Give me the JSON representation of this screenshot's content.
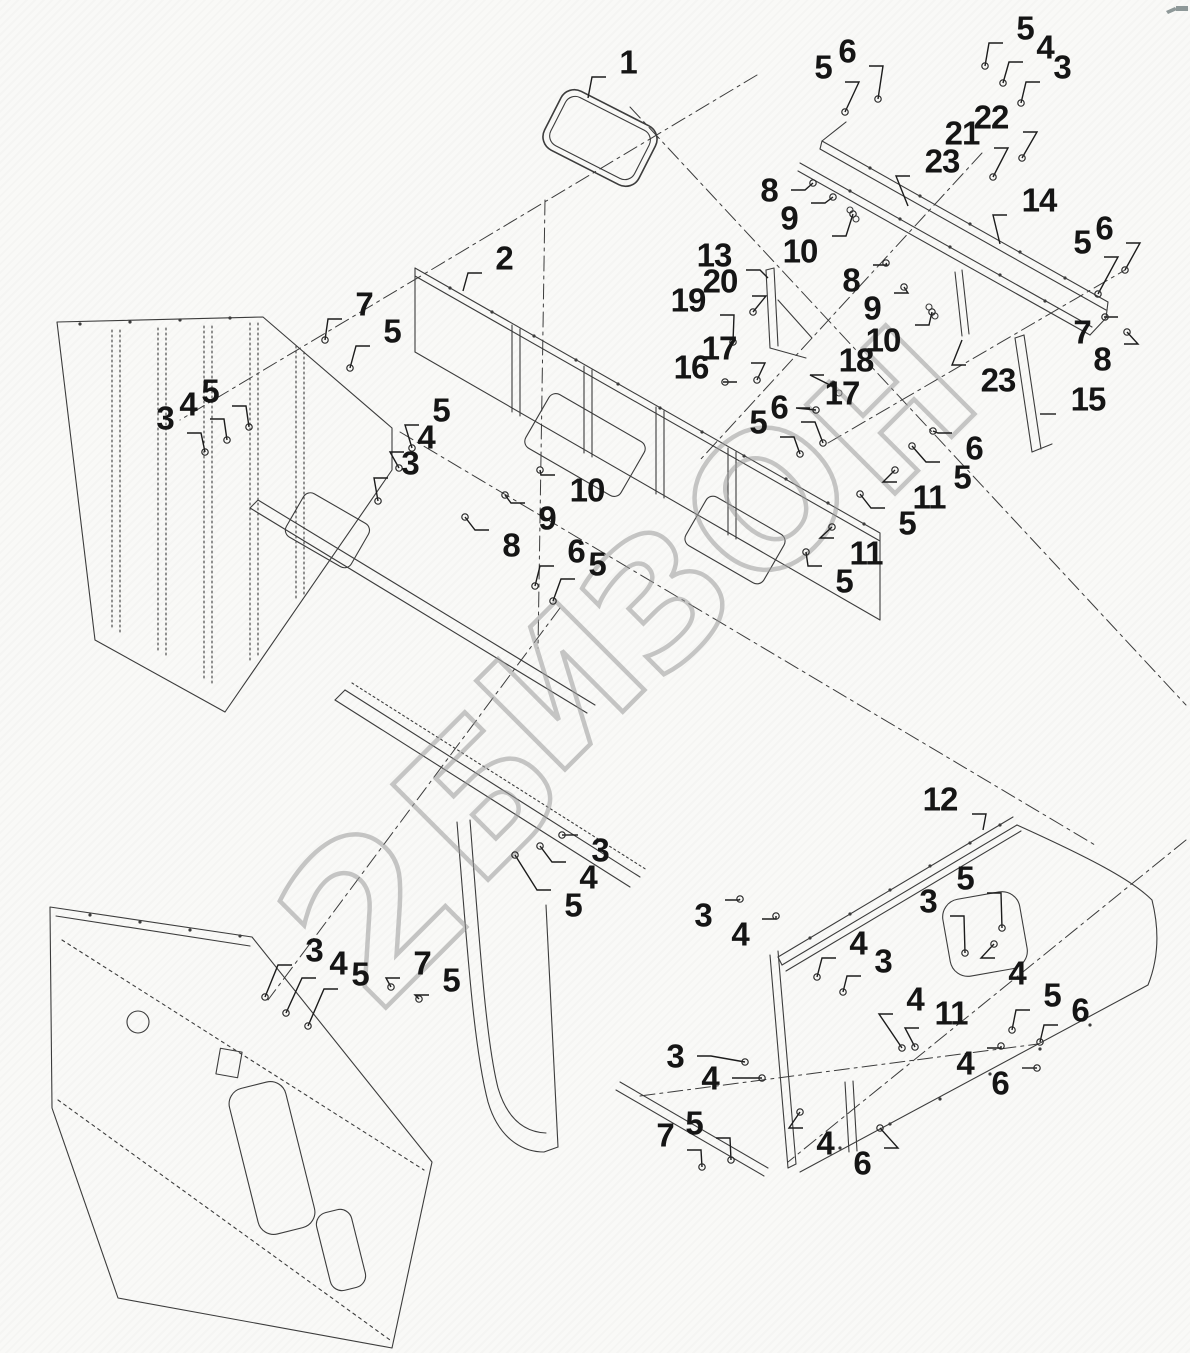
{
  "page": {
    "width": 1190,
    "height": 1353,
    "background": "#f9f9f7",
    "line_color": "#3c3c3c",
    "leader_color": "#1c1c1c",
    "label_color": "#151515"
  },
  "watermark": {
    "color": "#9b9b9b",
    "rotation_deg": -45,
    "letters": [
      {
        "ch": "2",
        "x": 374,
        "y": 914,
        "size": 215
      },
      {
        "ch": "Б",
        "x": 481,
        "y": 797,
        "size": 185
      },
      {
        "ch": "И",
        "x": 563,
        "y": 688,
        "size": 172
      },
      {
        "ch": "З",
        "x": 660,
        "y": 600,
        "size": 172
      },
      {
        "ch": "О",
        "x": 768,
        "y": 501,
        "size": 182
      },
      {
        "ch": "Н",
        "x": 893,
        "y": 412,
        "size": 172
      }
    ]
  },
  "no_marker_parts": [
    "1",
    "2",
    "12",
    "13",
    "14",
    "15",
    "18",
    "23"
  ],
  "callouts": [
    {
      "t": "1",
      "x": 628,
      "y": 62,
      "tx": 588,
      "ty": 98
    },
    {
      "t": "5",
      "x": 823,
      "y": 67,
      "tx": 845,
      "ty": 112
    },
    {
      "t": "6",
      "x": 847,
      "y": 51,
      "tx": 878,
      "ty": 99
    },
    {
      "t": "5",
      "x": 1025,
      "y": 28,
      "tx": 985,
      "ty": 66
    },
    {
      "t": "4",
      "x": 1045,
      "y": 47,
      "tx": 1003,
      "ty": 83
    },
    {
      "t": "3",
      "x": 1062,
      "y": 67,
      "tx": 1021,
      "ty": 103
    },
    {
      "t": "22",
      "x": 991,
      "y": 117,
      "tx": 1022,
      "ty": 158
    },
    {
      "t": "21",
      "x": 962,
      "y": 133,
      "tx": 993,
      "ty": 177
    },
    {
      "t": "23",
      "x": 942,
      "y": 161,
      "tx": 908,
      "ty": 206
    },
    {
      "t": "8",
      "x": 769,
      "y": 190,
      "tx": 813,
      "ty": 183
    },
    {
      "t": "9",
      "x": 789,
      "y": 218,
      "tx": 833,
      "ty": 197
    },
    {
      "t": "10",
      "x": 800,
      "y": 251,
      "tx": 853,
      "ty": 214
    },
    {
      "t": "14",
      "x": 1039,
      "y": 200,
      "tx": 1000,
      "ty": 244
    },
    {
      "t": "13",
      "x": 714,
      "y": 255,
      "tx": 768,
      "ty": 278
    },
    {
      "t": "20",
      "x": 720,
      "y": 281,
      "tx": 753,
      "ty": 312
    },
    {
      "t": "19",
      "x": 688,
      "y": 300,
      "tx": 733,
      "ty": 342
    },
    {
      "t": "2",
      "x": 504,
      "y": 258,
      "tx": 463,
      "ty": 291
    },
    {
      "t": "8",
      "x": 851,
      "y": 280,
      "tx": 886,
      "ty": 263
    },
    {
      "t": "9",
      "x": 872,
      "y": 308,
      "tx": 904,
      "ty": 287
    },
    {
      "t": "10",
      "x": 883,
      "y": 340,
      "tx": 932,
      "ty": 312
    },
    {
      "t": "6",
      "x": 1104,
      "y": 228,
      "tx": 1125,
      "ty": 270
    },
    {
      "t": "5",
      "x": 1082,
      "y": 242,
      "tx": 1098,
      "ty": 294
    },
    {
      "t": "7",
      "x": 1082,
      "y": 332,
      "tx": 1105,
      "ty": 317
    },
    {
      "t": "8",
      "x": 1102,
      "y": 359,
      "tx": 1127,
      "ty": 332
    },
    {
      "t": "16",
      "x": 691,
      "y": 367,
      "tx": 725,
      "ty": 382
    },
    {
      "t": "17",
      "x": 719,
      "y": 348,
      "tx": 757,
      "ty": 380
    },
    {
      "t": "18",
      "x": 856,
      "y": 360,
      "tx": 836,
      "ty": 388
    },
    {
      "t": "17",
      "x": 842,
      "y": 393,
      "tx": 816,
      "ty": 410
    },
    {
      "t": "23",
      "x": 998,
      "y": 380,
      "tx": 962,
      "ty": 340
    },
    {
      "t": "15",
      "x": 1088,
      "y": 399,
      "tx": 1040,
      "ty": 414
    },
    {
      "t": "7",
      "x": 364,
      "y": 304,
      "tx": 325,
      "ty": 340
    },
    {
      "t": "5",
      "x": 392,
      "y": 331,
      "tx": 350,
      "ty": 368
    },
    {
      "t": "3",
      "x": 165,
      "y": 418,
      "tx": 205,
      "ty": 452
    },
    {
      "t": "4",
      "x": 188,
      "y": 404,
      "tx": 227,
      "ty": 440
    },
    {
      "t": "5",
      "x": 210,
      "y": 391,
      "tx": 249,
      "ty": 427
    },
    {
      "t": "5",
      "x": 441,
      "y": 410,
      "tx": 412,
      "ty": 448
    },
    {
      "t": "4",
      "x": 426,
      "y": 437,
      "tx": 399,
      "ty": 468
    },
    {
      "t": "3",
      "x": 410,
      "y": 463,
      "tx": 378,
      "ty": 501
    },
    {
      "t": "10",
      "x": 587,
      "y": 490,
      "tx": 540,
      "ty": 470
    },
    {
      "t": "9",
      "x": 547,
      "y": 518,
      "tx": 505,
      "ty": 495
    },
    {
      "t": "8",
      "x": 511,
      "y": 545,
      "tx": 465,
      "ty": 517
    },
    {
      "t": "6",
      "x": 576,
      "y": 551,
      "tx": 535,
      "ty": 586
    },
    {
      "t": "5",
      "x": 597,
      "y": 564,
      "tx": 553,
      "ty": 601
    },
    {
      "t": "6",
      "x": 779,
      "y": 407,
      "tx": 823,
      "ty": 443
    },
    {
      "t": "5",
      "x": 758,
      "y": 422,
      "tx": 800,
      "ty": 454
    },
    {
      "t": "6",
      "x": 974,
      "y": 448,
      "tx": 933,
      "ty": 431
    },
    {
      "t": "5",
      "x": 962,
      "y": 477,
      "tx": 912,
      "ty": 446
    },
    {
      "t": "11",
      "x": 929,
      "y": 497,
      "tx": 895,
      "ty": 470
    },
    {
      "t": "5",
      "x": 907,
      "y": 523,
      "tx": 860,
      "ty": 494
    },
    {
      "t": "11",
      "x": 866,
      "y": 553,
      "tx": 832,
      "ty": 527
    },
    {
      "t": "5",
      "x": 844,
      "y": 581,
      "tx": 806,
      "ty": 552
    },
    {
      "t": "3",
      "x": 600,
      "y": 850,
      "tx": 562,
      "ty": 835
    },
    {
      "t": "4",
      "x": 588,
      "y": 877,
      "tx": 540,
      "ty": 846
    },
    {
      "t": "5",
      "x": 573,
      "y": 905,
      "tx": 515,
      "ty": 855
    },
    {
      "t": "3",
      "x": 314,
      "y": 950,
      "tx": 265,
      "ty": 997
    },
    {
      "t": "4",
      "x": 338,
      "y": 963,
      "tx": 286,
      "ty": 1013
    },
    {
      "t": "5",
      "x": 360,
      "y": 974,
      "tx": 308,
      "ty": 1026
    },
    {
      "t": "7",
      "x": 422,
      "y": 963,
      "tx": 391,
      "ty": 987
    },
    {
      "t": "5",
      "x": 451,
      "y": 980,
      "tx": 419,
      "ty": 999
    },
    {
      "t": "3",
      "x": 675,
      "y": 1056,
      "tx": 745,
      "ty": 1062
    },
    {
      "t": "4",
      "x": 710,
      "y": 1078,
      "tx": 762,
      "ty": 1078
    },
    {
      "t": "7",
      "x": 665,
      "y": 1135,
      "tx": 702,
      "ty": 1167
    },
    {
      "t": "5",
      "x": 694,
      "y": 1123,
      "tx": 731,
      "ty": 1160
    },
    {
      "t": "4",
      "x": 825,
      "y": 1143,
      "tx": 800,
      "ty": 1112
    },
    {
      "t": "6",
      "x": 862,
      "y": 1163,
      "tx": 880,
      "ty": 1128
    },
    {
      "t": "12",
      "x": 940,
      "y": 799,
      "tx": 983,
      "ty": 830
    },
    {
      "t": "3",
      "x": 703,
      "y": 915,
      "tx": 740,
      "ty": 899
    },
    {
      "t": "4",
      "x": 740,
      "y": 934,
      "tx": 776,
      "ty": 916
    },
    {
      "t": "4",
      "x": 858,
      "y": 943,
      "tx": 817,
      "ty": 977
    },
    {
      "t": "3",
      "x": 883,
      "y": 961,
      "tx": 843,
      "ty": 992
    },
    {
      "t": "3",
      "x": 928,
      "y": 901,
      "tx": 965,
      "ty": 953
    },
    {
      "t": "5",
      "x": 965,
      "y": 878,
      "tx": 1002,
      "ty": 928
    },
    {
      "t": "4",
      "x": 1017,
      "y": 973,
      "tx": 994,
      "ty": 944
    },
    {
      "t": "4",
      "x": 915,
      "y": 999,
      "tx": 902,
      "ty": 1048
    },
    {
      "t": "11",
      "x": 951,
      "y": 1013,
      "tx": 915,
      "ty": 1047
    },
    {
      "t": "5",
      "x": 1052,
      "y": 995,
      "tx": 1012,
      "ty": 1030
    },
    {
      "t": "6",
      "x": 1080,
      "y": 1010,
      "tx": 1040,
      "ty": 1042
    },
    {
      "t": "4",
      "x": 965,
      "y": 1063,
      "tx": 1001,
      "ty": 1046
    },
    {
      "t": "6",
      "x": 1000,
      "y": 1083,
      "tx": 1037,
      "ty": 1068
    }
  ]
}
